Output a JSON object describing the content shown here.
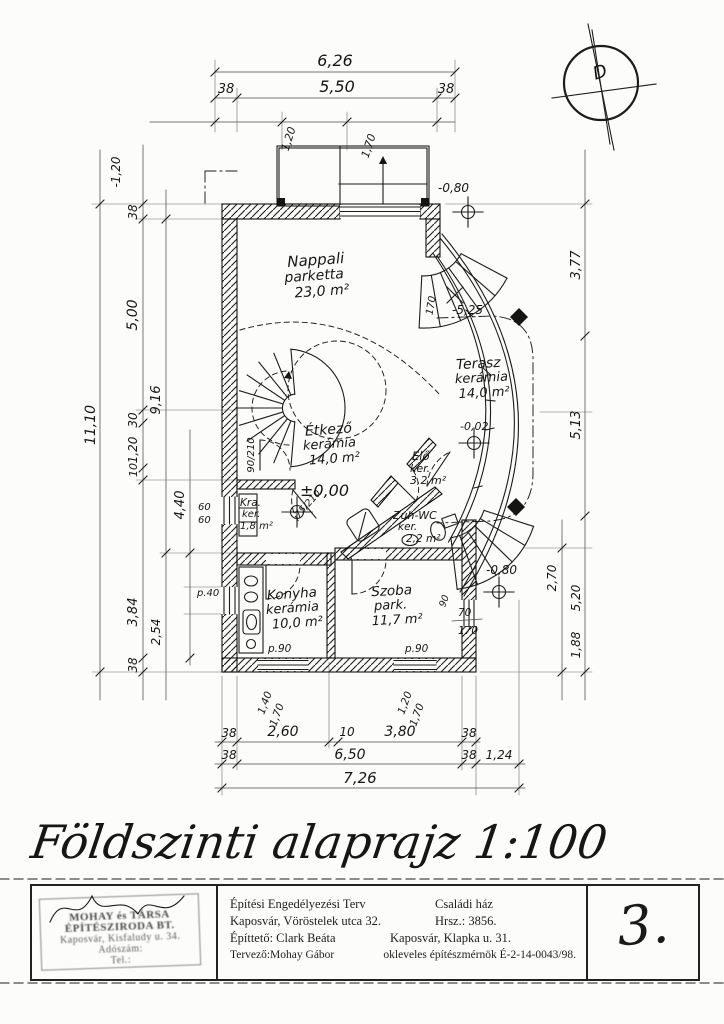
{
  "page": {
    "title": "Földszinti alaprajz 1:100",
    "sheet_number": "3."
  },
  "north_arrow": {
    "letter": "D"
  },
  "rooms": [
    {
      "name": "Nappali",
      "finish": "parketta",
      "area": "23,0 m²"
    },
    {
      "name": "Terasz",
      "finish": "kerámia",
      "area": "14,0 m²"
    },
    {
      "name": "Étkező",
      "finish": "kerámia",
      "area": "14,0 m²"
    },
    {
      "name": "Elő",
      "finish": "ker.",
      "area": "3,2 m²"
    },
    {
      "name": "Zuh-WC",
      "finish": "ker.",
      "area": "2,2 m²"
    },
    {
      "name": "Kra.",
      "finish": "ker.",
      "area": "1,8 m²"
    },
    {
      "name": "Konyha",
      "finish": "kerámia",
      "area": "10,0 m²"
    },
    {
      "name": "Szoba",
      "finish": "park.",
      "area": "11,7 m²"
    }
  ],
  "levels": {
    "main": "±0,00",
    "terrace": "-0,02",
    "garden_upper": "-0,80",
    "garden_lower": "-0,80",
    "slope": "-5,25",
    "upper_left": "-1,20"
  },
  "dimensions": {
    "top": {
      "overall": "6,26",
      "w1": "38",
      "clear": "5,50",
      "w2": "38"
    },
    "bottom": {
      "r1": [
        "38",
        "2,60",
        "10",
        "3,80",
        "38"
      ],
      "r2": [
        "38",
        "6,50",
        "38",
        "1,24"
      ],
      "overall": "7,26"
    },
    "left": {
      "overall": "11,10",
      "chain": [
        "38",
        "5,00",
        "30",
        "1,20",
        "10",
        "3,84",
        "38"
      ],
      "inner": [
        "9,16",
        "4,40",
        "2,54"
      ],
      "small": [
        "60",
        "60"
      ],
      "parapet": "p.40"
    },
    "right": {
      "chain": [
        "3,77",
        "5,13",
        "2,70",
        "5,20",
        "1,88"
      ]
    },
    "balcony": [
      "1,20",
      "1,70"
    ],
    "entry_stair": "170"
  },
  "openings": {
    "stair_door": "90/210",
    "pantry_door": "75/210",
    "kitchen_window": [
      "1,40",
      "1,70"
    ],
    "room_window": [
      "1,20",
      "1,70"
    ],
    "side_window": [
      "70",
      "170"
    ],
    "side_parapet": "90",
    "parapet_kitchen": "p.90",
    "parapet_room": "p.90"
  },
  "title_block": {
    "rows": [
      {
        "left": "Építési Engedélyezési Terv",
        "right": "Családi ház"
      },
      {
        "left": "Kaposvár, Vöröstelek utca 32.",
        "right": "Hrsz.: 3856."
      },
      {
        "left": "Építtető: Clark Beáta",
        "right": "Kaposvár, Klapka u. 31."
      },
      {
        "left": "Tervező:Mohay Gábor",
        "right": "okleveles építészmérnök  É-2-14-0043/98."
      }
    ],
    "stamp": {
      "line1": "MOHAY és TÁRSA",
      "line2": "ÉPÍTÉSZIRODA BT.",
      "line3": "Kaposvár, Kisfaludy u. 34.",
      "line4": "Adószám:",
      "line5": "Tel.:"
    }
  }
}
